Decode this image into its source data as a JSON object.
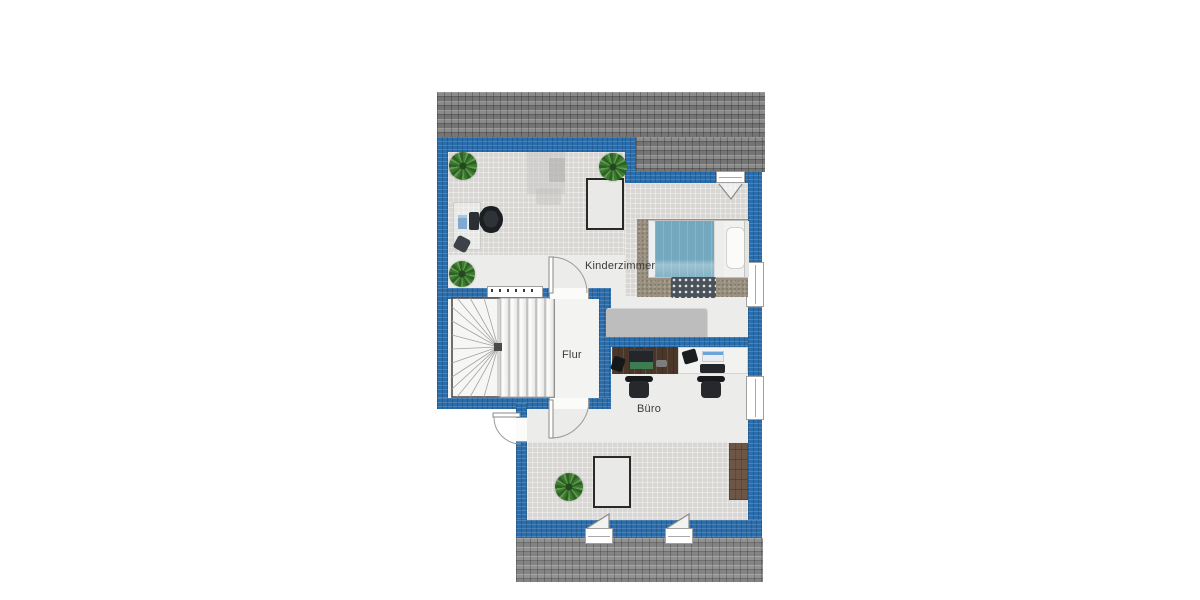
{
  "page": {
    "background": "#ffffff",
    "type": "floor-plan"
  },
  "plan": {
    "rooms": [
      {
        "id": "kinderzimmer",
        "label": "Kinderzimmer",
        "furniture": [
          "bed",
          "bed-rug",
          "doormat",
          "desk",
          "office-chair",
          "monitor",
          "papers",
          "wastebasket",
          "wardrobe",
          "ghost-table",
          "roof-window",
          "plant",
          "plant",
          "plant"
        ]
      },
      {
        "id": "flur",
        "label": "Flur",
        "furniture": [
          "winder-staircase"
        ]
      },
      {
        "id": "buero",
        "label": "Büro",
        "furniture": [
          "wood-desk",
          "white-desk",
          "laptop",
          "desk-phone",
          "desk-phone",
          "printer",
          "monitor",
          "office-chair",
          "office-chair",
          "sideboard",
          "roof-window",
          "plant"
        ]
      }
    ],
    "openings": {
      "doors": [
        "kinderzimmer-door",
        "flur-door",
        "exterior-door"
      ],
      "windows": [
        "right-window-1",
        "right-window-2",
        "top-window",
        "dormer-window-1",
        "dormer-window-2",
        "stair-window"
      ]
    },
    "colors": {
      "wall": "#2a6dac",
      "roof": "#757575",
      "roof_lower": "#8a8a8a",
      "floor_tile": "#d8d7d4",
      "floor_smooth": "#ececea",
      "stair_floor": "#f3f3f1",
      "blanket": "#73a8be",
      "rug": "#9a9080",
      "wood_desk": "#4a372a",
      "sideboard": "#6d5646",
      "closet": "#bdbdbd",
      "plant": "#3c7a31"
    }
  }
}
